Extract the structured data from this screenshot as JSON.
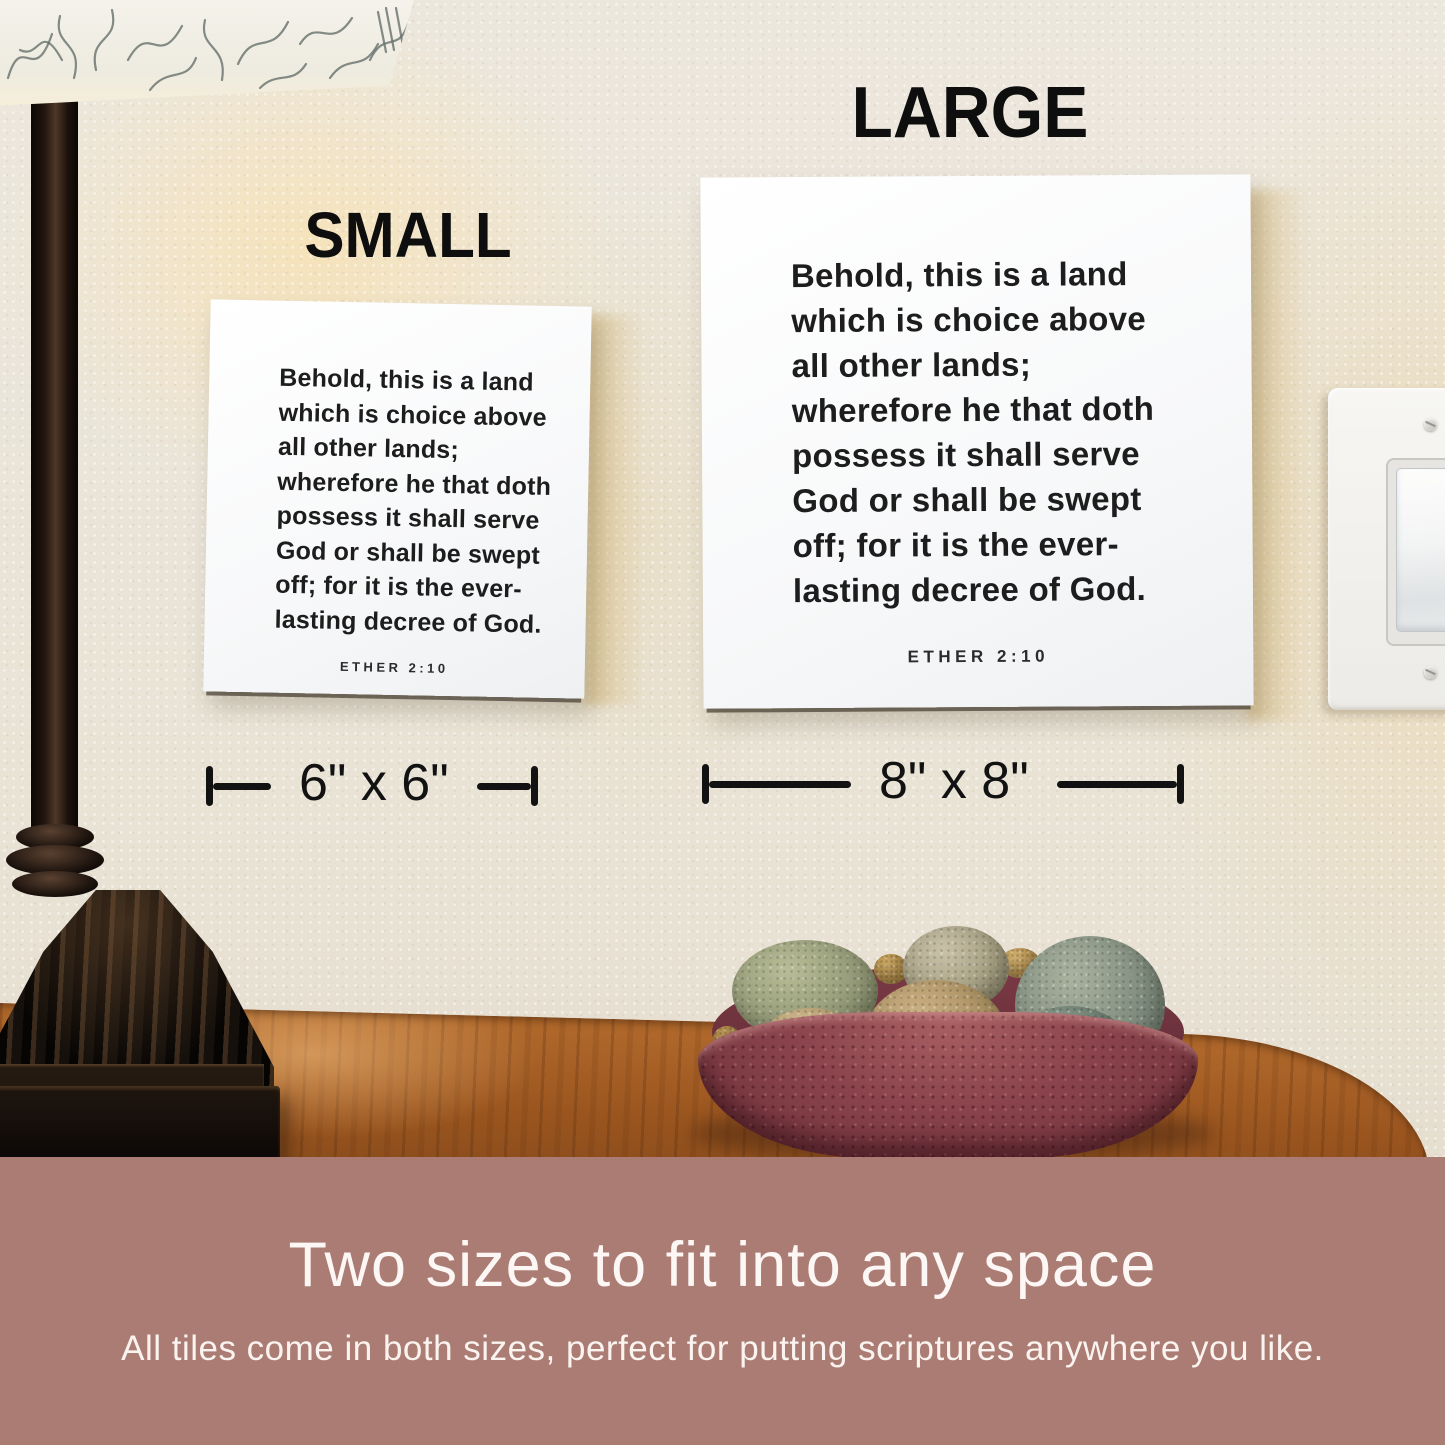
{
  "labels": {
    "small": "SMALL",
    "large": "LARGE"
  },
  "tile": {
    "verse_lines": [
      "Behold, this is a land",
      "which is choice above",
      "all other lands;",
      "wherefore he that doth",
      "possess it shall serve",
      "God or shall be swept",
      "off; for it is the ever-",
      "lasting decree of God."
    ],
    "reference": "ETHER 2:10"
  },
  "dimensions": {
    "small": "6\" x 6\"",
    "large": "8\" x 8\""
  },
  "banner": {
    "headline": "Two sizes to fit into any space",
    "subtext": "All tiles come in both sizes, perfect for putting scriptures anywhere you like."
  },
  "colors": {
    "banner_bg": "#aa7c73",
    "wall": "#eae5db",
    "tile_face": "#f8f9fa",
    "tile_text": "#1d1d1d",
    "annotation": "#121212",
    "table_wood": "#9a551f",
    "bowl": "#8a434c"
  }
}
